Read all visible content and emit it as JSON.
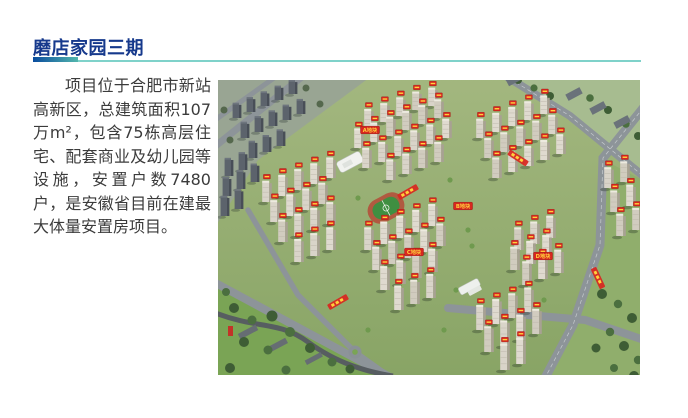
{
  "header": {
    "title": "磨店家园三期",
    "title_color": "#16398c",
    "accent_gradient": [
      "#0a4c9e",
      "#52b6ad"
    ],
    "rule_color": "#7fd2ca"
  },
  "body": {
    "paragraph": "项目位于合肥市新站高新区，总建筑面积107万m²，包含75栋高层住宅、配套商业及幼儿园等设施，安置户数7480户，是安徽省目前在建最大体量安置房项目。",
    "text_color": "#3b3b3b"
  },
  "image": {
    "alt": "磨店家园三期项目鸟瞰效果图：大型安置房小区，多栋高层住宅带红色楼号标牌，含学校、运动场及周边道路绿地",
    "tag_color": "#d8271f",
    "tag_text_color": "#ffd23d",
    "plot_banners": [
      {
        "label": "A地块",
        "x": 152,
        "y": 50
      },
      {
        "label": "B地块",
        "x": 245,
        "y": 126
      },
      {
        "label": "C地块",
        "x": 196,
        "y": 172
      },
      {
        "label": "D地块",
        "x": 325,
        "y": 176
      }
    ],
    "road_banners": [
      {
        "x": 120,
        "y": 222,
        "rot": -30
      },
      {
        "x": 190,
        "y": 112,
        "rot": -30
      },
      {
        "x": 300,
        "y": 78,
        "rot": 33
      },
      {
        "x": 380,
        "y": 198,
        "rot": 65
      }
    ],
    "towers_main": [
      [
        150,
        48
      ],
      [
        166,
        42
      ],
      [
        182,
        36
      ],
      [
        198,
        30
      ],
      [
        214,
        26
      ],
      [
        140,
        68
      ],
      [
        156,
        62
      ],
      [
        172,
        56
      ],
      [
        188,
        50
      ],
      [
        204,
        44
      ],
      [
        220,
        38
      ],
      [
        148,
        88
      ],
      [
        164,
        82
      ],
      [
        180,
        76
      ],
      [
        196,
        70
      ],
      [
        212,
        64
      ],
      [
        228,
        58
      ],
      [
        172,
        100
      ],
      [
        188,
        94
      ],
      [
        204,
        88
      ],
      [
        220,
        82
      ],
      [
        262,
        58
      ],
      [
        278,
        52
      ],
      [
        294,
        46
      ],
      [
        310,
        40
      ],
      [
        326,
        34
      ],
      [
        270,
        78
      ],
      [
        286,
        72
      ],
      [
        302,
        66
      ],
      [
        318,
        60
      ],
      [
        334,
        54
      ],
      [
        278,
        98
      ],
      [
        294,
        92
      ],
      [
        310,
        86
      ],
      [
        326,
        80
      ],
      [
        342,
        74
      ],
      [
        48,
        122
      ],
      [
        64,
        116
      ],
      [
        80,
        110
      ],
      [
        96,
        104
      ],
      [
        112,
        98
      ],
      [
        56,
        142
      ],
      [
        72,
        136
      ],
      [
        88,
        130
      ],
      [
        104,
        124
      ],
      [
        64,
        162
      ],
      [
        80,
        156
      ],
      [
        96,
        150
      ],
      [
        112,
        144
      ],
      [
        80,
        182
      ],
      [
        96,
        176
      ],
      [
        112,
        170
      ],
      [
        150,
        170
      ],
      [
        166,
        164
      ],
      [
        182,
        158
      ],
      [
        198,
        152
      ],
      [
        214,
        146
      ],
      [
        158,
        190
      ],
      [
        174,
        184
      ],
      [
        190,
        178
      ],
      [
        206,
        172
      ],
      [
        222,
        166
      ],
      [
        166,
        210
      ],
      [
        182,
        204
      ],
      [
        198,
        198
      ],
      [
        214,
        192
      ],
      [
        180,
        230
      ],
      [
        196,
        224
      ],
      [
        212,
        218
      ],
      [
        300,
        170
      ],
      [
        316,
        164
      ],
      [
        332,
        158
      ],
      [
        296,
        190
      ],
      [
        312,
        184
      ],
      [
        328,
        178
      ],
      [
        308,
        205
      ],
      [
        324,
        199
      ],
      [
        340,
        193
      ],
      [
        262,
        250
      ],
      [
        278,
        244
      ],
      [
        294,
        238
      ],
      [
        310,
        232
      ],
      [
        270,
        272
      ],
      [
        286,
        266
      ],
      [
        302,
        260
      ],
      [
        318,
        254
      ],
      [
        286,
        290
      ],
      [
        302,
        284
      ],
      [
        390,
        108
      ],
      [
        406,
        102
      ],
      [
        396,
        132
      ],
      [
        412,
        126
      ],
      [
        402,
        156
      ],
      [
        418,
        150
      ]
    ],
    "towers_bg": [
      [
        18,
        38
      ],
      [
        32,
        32
      ],
      [
        46,
        26
      ],
      [
        60,
        20
      ],
      [
        74,
        14
      ],
      [
        26,
        58
      ],
      [
        40,
        52
      ],
      [
        54,
        46
      ],
      [
        68,
        40
      ],
      [
        82,
        34
      ],
      [
        34,
        78
      ],
      [
        48,
        72
      ],
      [
        62,
        66
      ],
      [
        10,
        96
      ],
      [
        24,
        90
      ],
      [
        8,
        116
      ],
      [
        22,
        109
      ],
      [
        36,
        102
      ],
      [
        6,
        136
      ],
      [
        20,
        129
      ]
    ]
  }
}
